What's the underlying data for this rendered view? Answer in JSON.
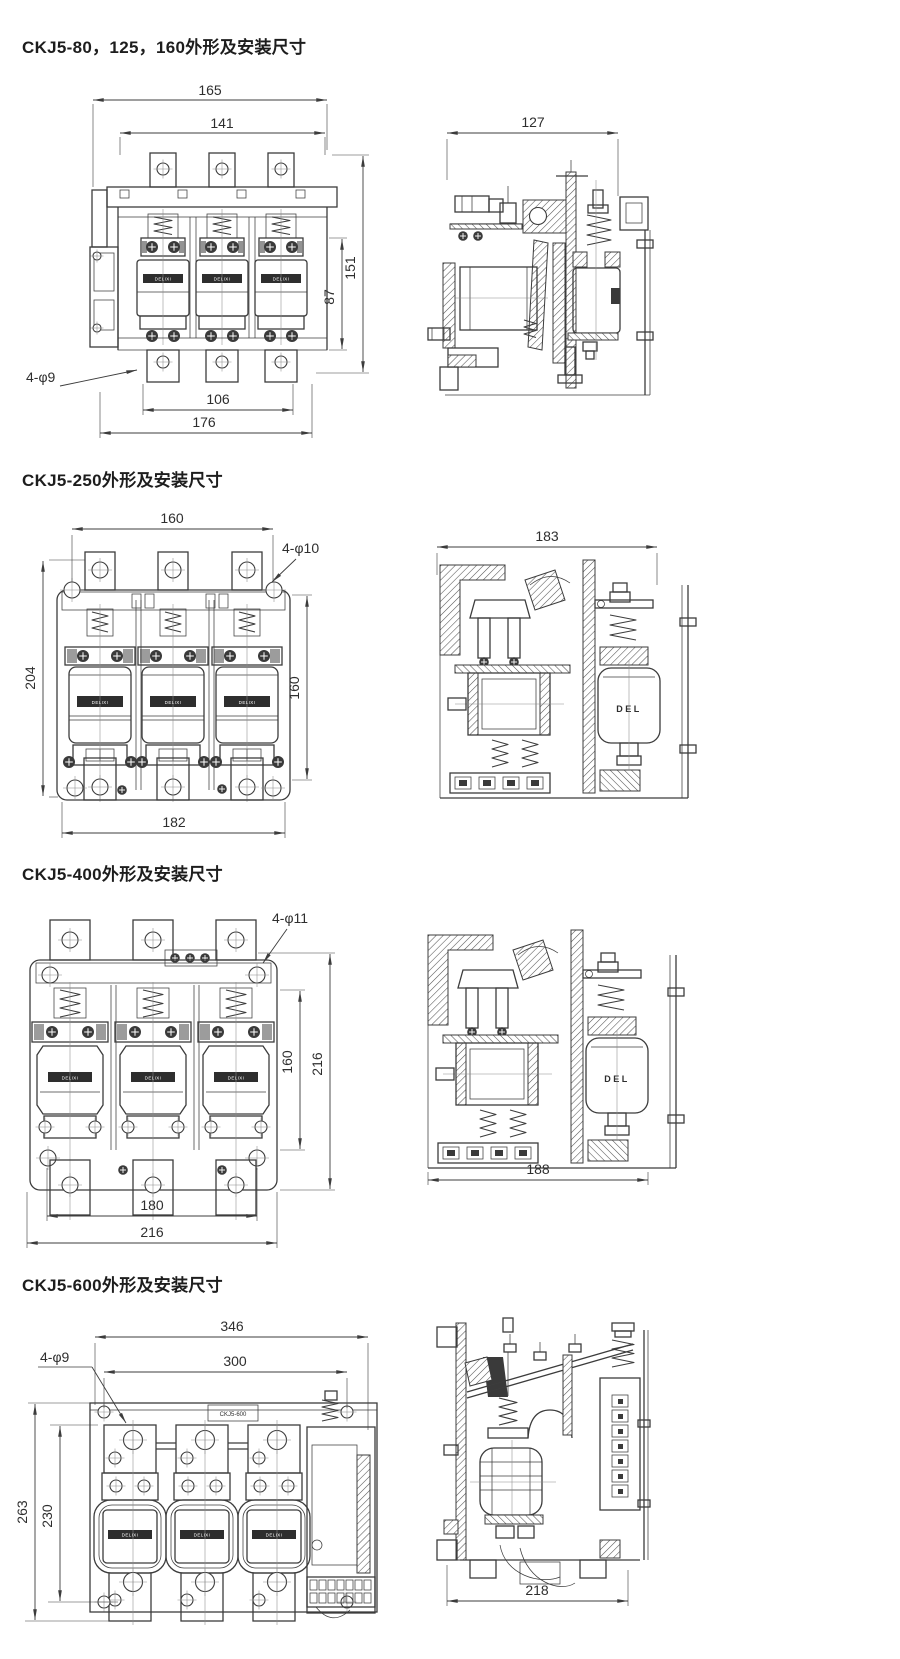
{
  "page": {
    "background": "#ffffff"
  },
  "labels": {
    "band": "DELIXI",
    "del": "DEL"
  },
  "sections": [
    {
      "title": "CKJ5-80，125，160外形及安装尺寸",
      "front": {
        "dim_overall_width": "165",
        "dim_mount_width": "141",
        "dim_height": "151",
        "dim_inner_height": "87",
        "dim_bottom_mount": "106",
        "dim_bottom_overall": "176",
        "hole_callout": "4-φ9"
      },
      "side": {
        "dim_depth": "127"
      }
    },
    {
      "title": "CKJ5-250外形及安装尺寸",
      "front": {
        "dim_mount_width": "160",
        "dim_height": "204",
        "dim_mount_height": "160",
        "dim_bottom": "182",
        "hole_callout": "4-φ10"
      },
      "side": {
        "dim_depth": "183"
      }
    },
    {
      "title": "CKJ5-400外形及安装尺寸",
      "front": {
        "dim_mount_height": "160",
        "dim_height": "216",
        "dim_bottom_mount": "180",
        "dim_bottom_overall": "216",
        "hole_callout": "4-φ11"
      },
      "side": {
        "dim_depth": "188"
      }
    },
    {
      "title": "CKJ5-600外形及安装尺寸",
      "front": {
        "dim_overall_width": "346",
        "dim_mount_width": "300",
        "dim_height": "263",
        "dim_mount_height": "230",
        "hole_callout": "4-φ9",
        "device_label": "CKJ5-600"
      },
      "side": {
        "dim_depth": "218"
      }
    }
  ]
}
